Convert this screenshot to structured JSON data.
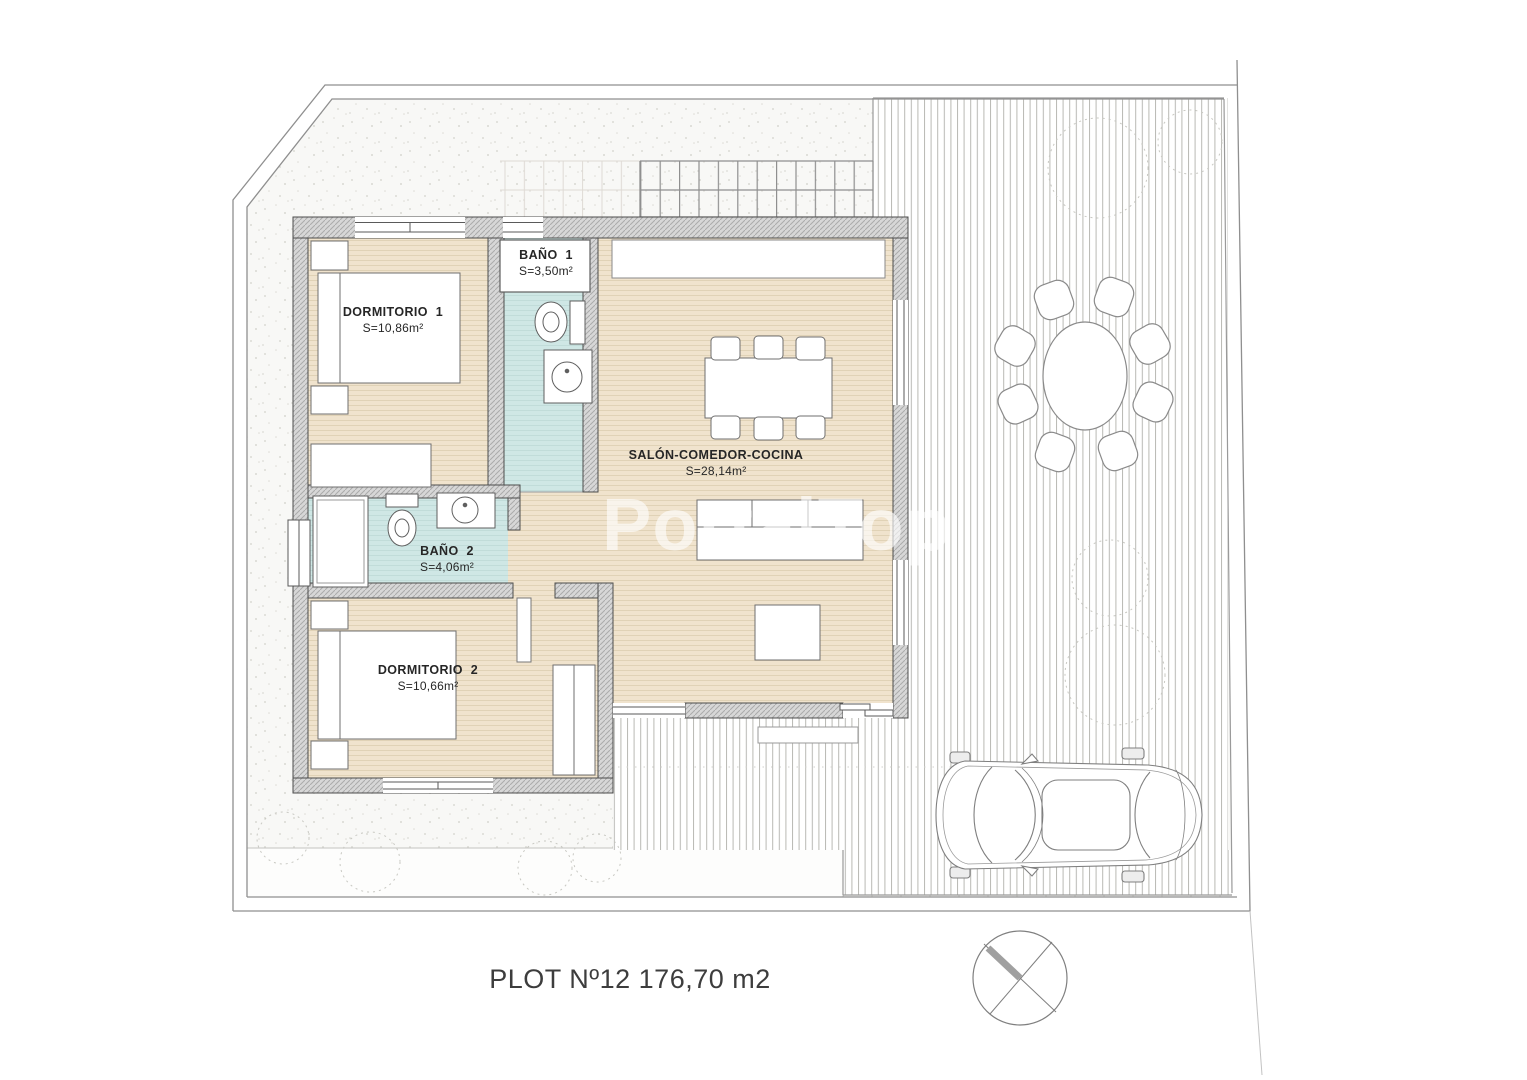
{
  "rooms": [
    {
      "name": "DORMITORIO 1",
      "area": "S=10,86m²"
    },
    {
      "name": "BAÑO 1",
      "area": "S=3,50m²"
    },
    {
      "name": "SALÓN-COMEDOR-COCINA",
      "area": "S=28,14m²"
    },
    {
      "name": "BAÑO 2",
      "area": "S=4,06m²"
    },
    {
      "name": "DORMITORIO 2",
      "area": "S=10,66m²"
    }
  ],
  "plot": {
    "label": "PLOT Nº12 176,70 m2"
  },
  "watermark": {
    "text": "PortalTop"
  },
  "icons": {
    "compass": "north-compass-icon",
    "car": "car-top-view-icon",
    "outdoor_table": "outdoor-dining-set-icon",
    "pergola": "pergola-grid-icon",
    "trees": "tree-canopy-icon"
  },
  "colors": {
    "wood_floor": "#f0e3cd",
    "bathroom_floor": "#cfe7e5",
    "wall_fill": "#d7d7d7",
    "deck_line": "#b9b9b4",
    "boundary_line": "#8f8f8f",
    "label_text": "#262626",
    "plot_text": "#3d3d3d",
    "watermark": "rgba(255,255,255,0.62)"
  }
}
